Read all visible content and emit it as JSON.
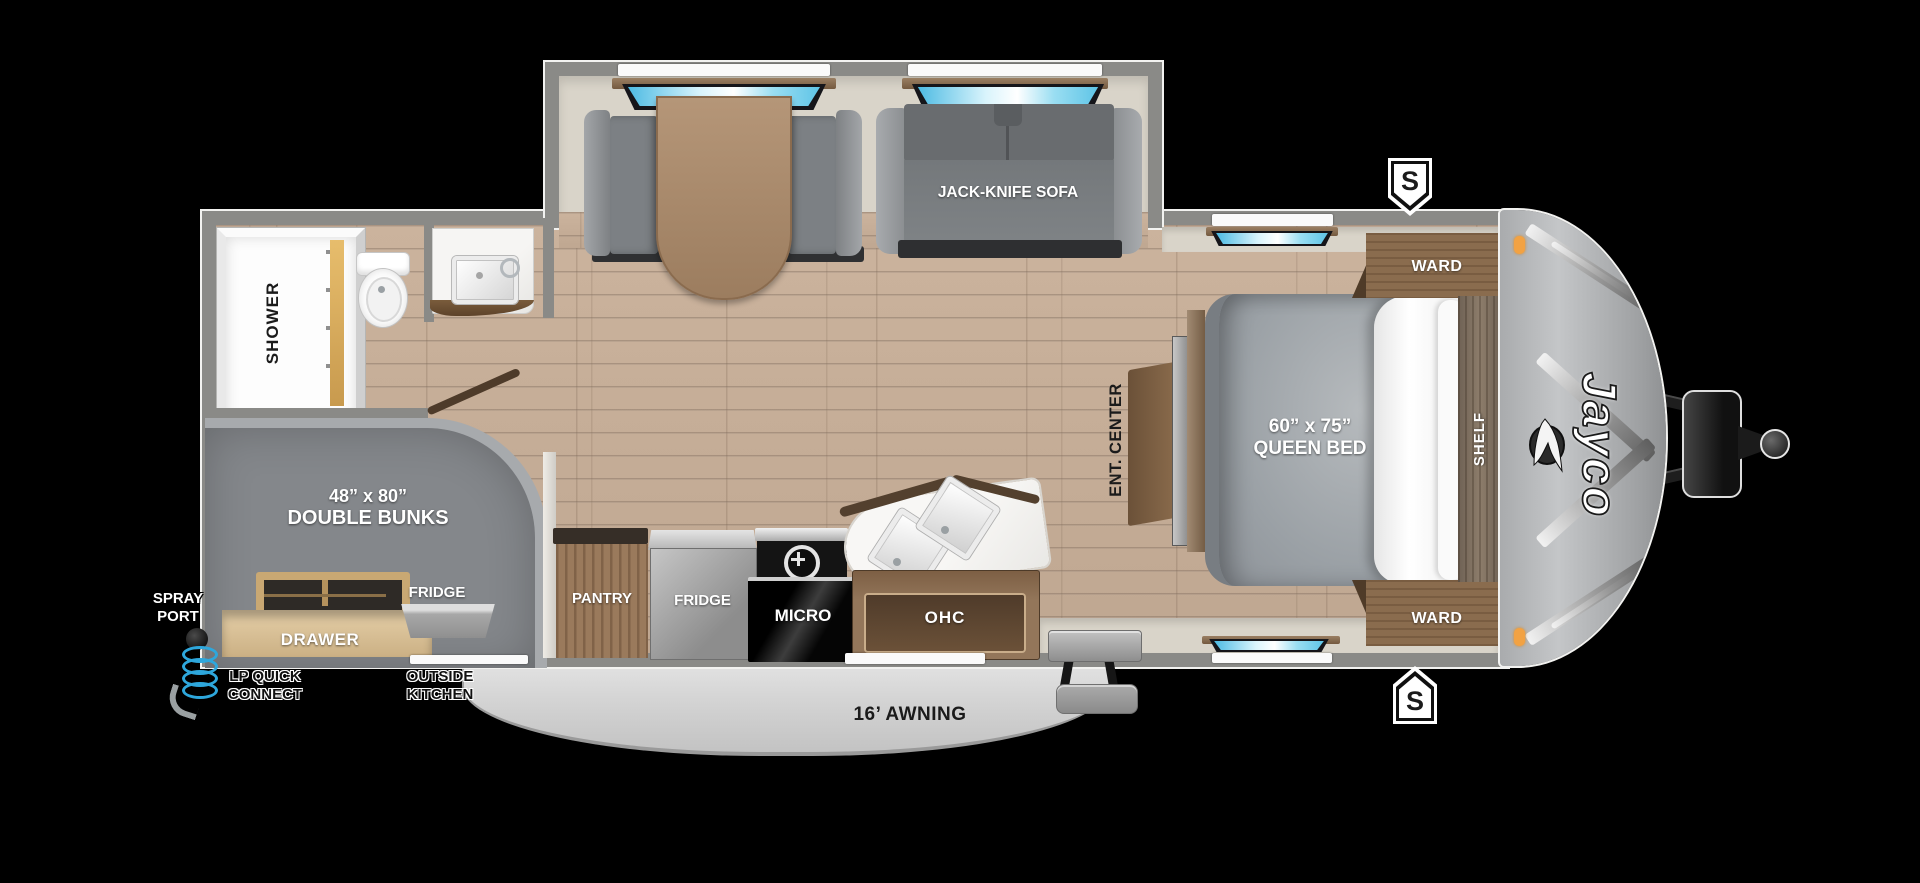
{
  "colors": {
    "wall_gray": "#8a8a87",
    "floor_wood": "#c6ae98",
    "slide_interior": "#d9d4c9",
    "front_cap": "#b3b5b7",
    "window_blue": "#49b9e2",
    "marker_orange": "#f2a243",
    "bunk_gray": "#84878b",
    "awning_gray": "#dcdcdc"
  },
  "exterior": {
    "awning_label": "16’ AWNING",
    "spray_port_line1": "SPRAY",
    "spray_port_line2": "PORT",
    "lp_connect_line1": "LP QUICK",
    "lp_connect_line2": "CONNECT",
    "outside_kitchen_line1": "OUTSIDE",
    "outside_kitchen_line2": "KITCHEN",
    "speaker_top": "S",
    "speaker_bottom": "S",
    "brand": "Jayco"
  },
  "bathroom": {
    "shower_label": "SHOWER"
  },
  "bunks": {
    "size_label": "48” x 80”",
    "name_label": "DOUBLE BUNKS",
    "drawer_label": "DRAWER",
    "exterior_fridge_label": "FRIDGE"
  },
  "kitchen": {
    "pantry_label": "PANTRY",
    "fridge_label": "FRIDGE",
    "micro_label": "MICRO",
    "ohc_label": "OHC"
  },
  "living": {
    "sofa_label": "JACK-KNIFE SOFA"
  },
  "bedroom": {
    "ent_center_label": "ENT. CENTER",
    "bed_size_label": "60” x 75”",
    "bed_type_label": "QUEEN BED",
    "ward_top_label": "WARD",
    "ward_bottom_label": "WARD",
    "shelf_label": "SHELF"
  }
}
